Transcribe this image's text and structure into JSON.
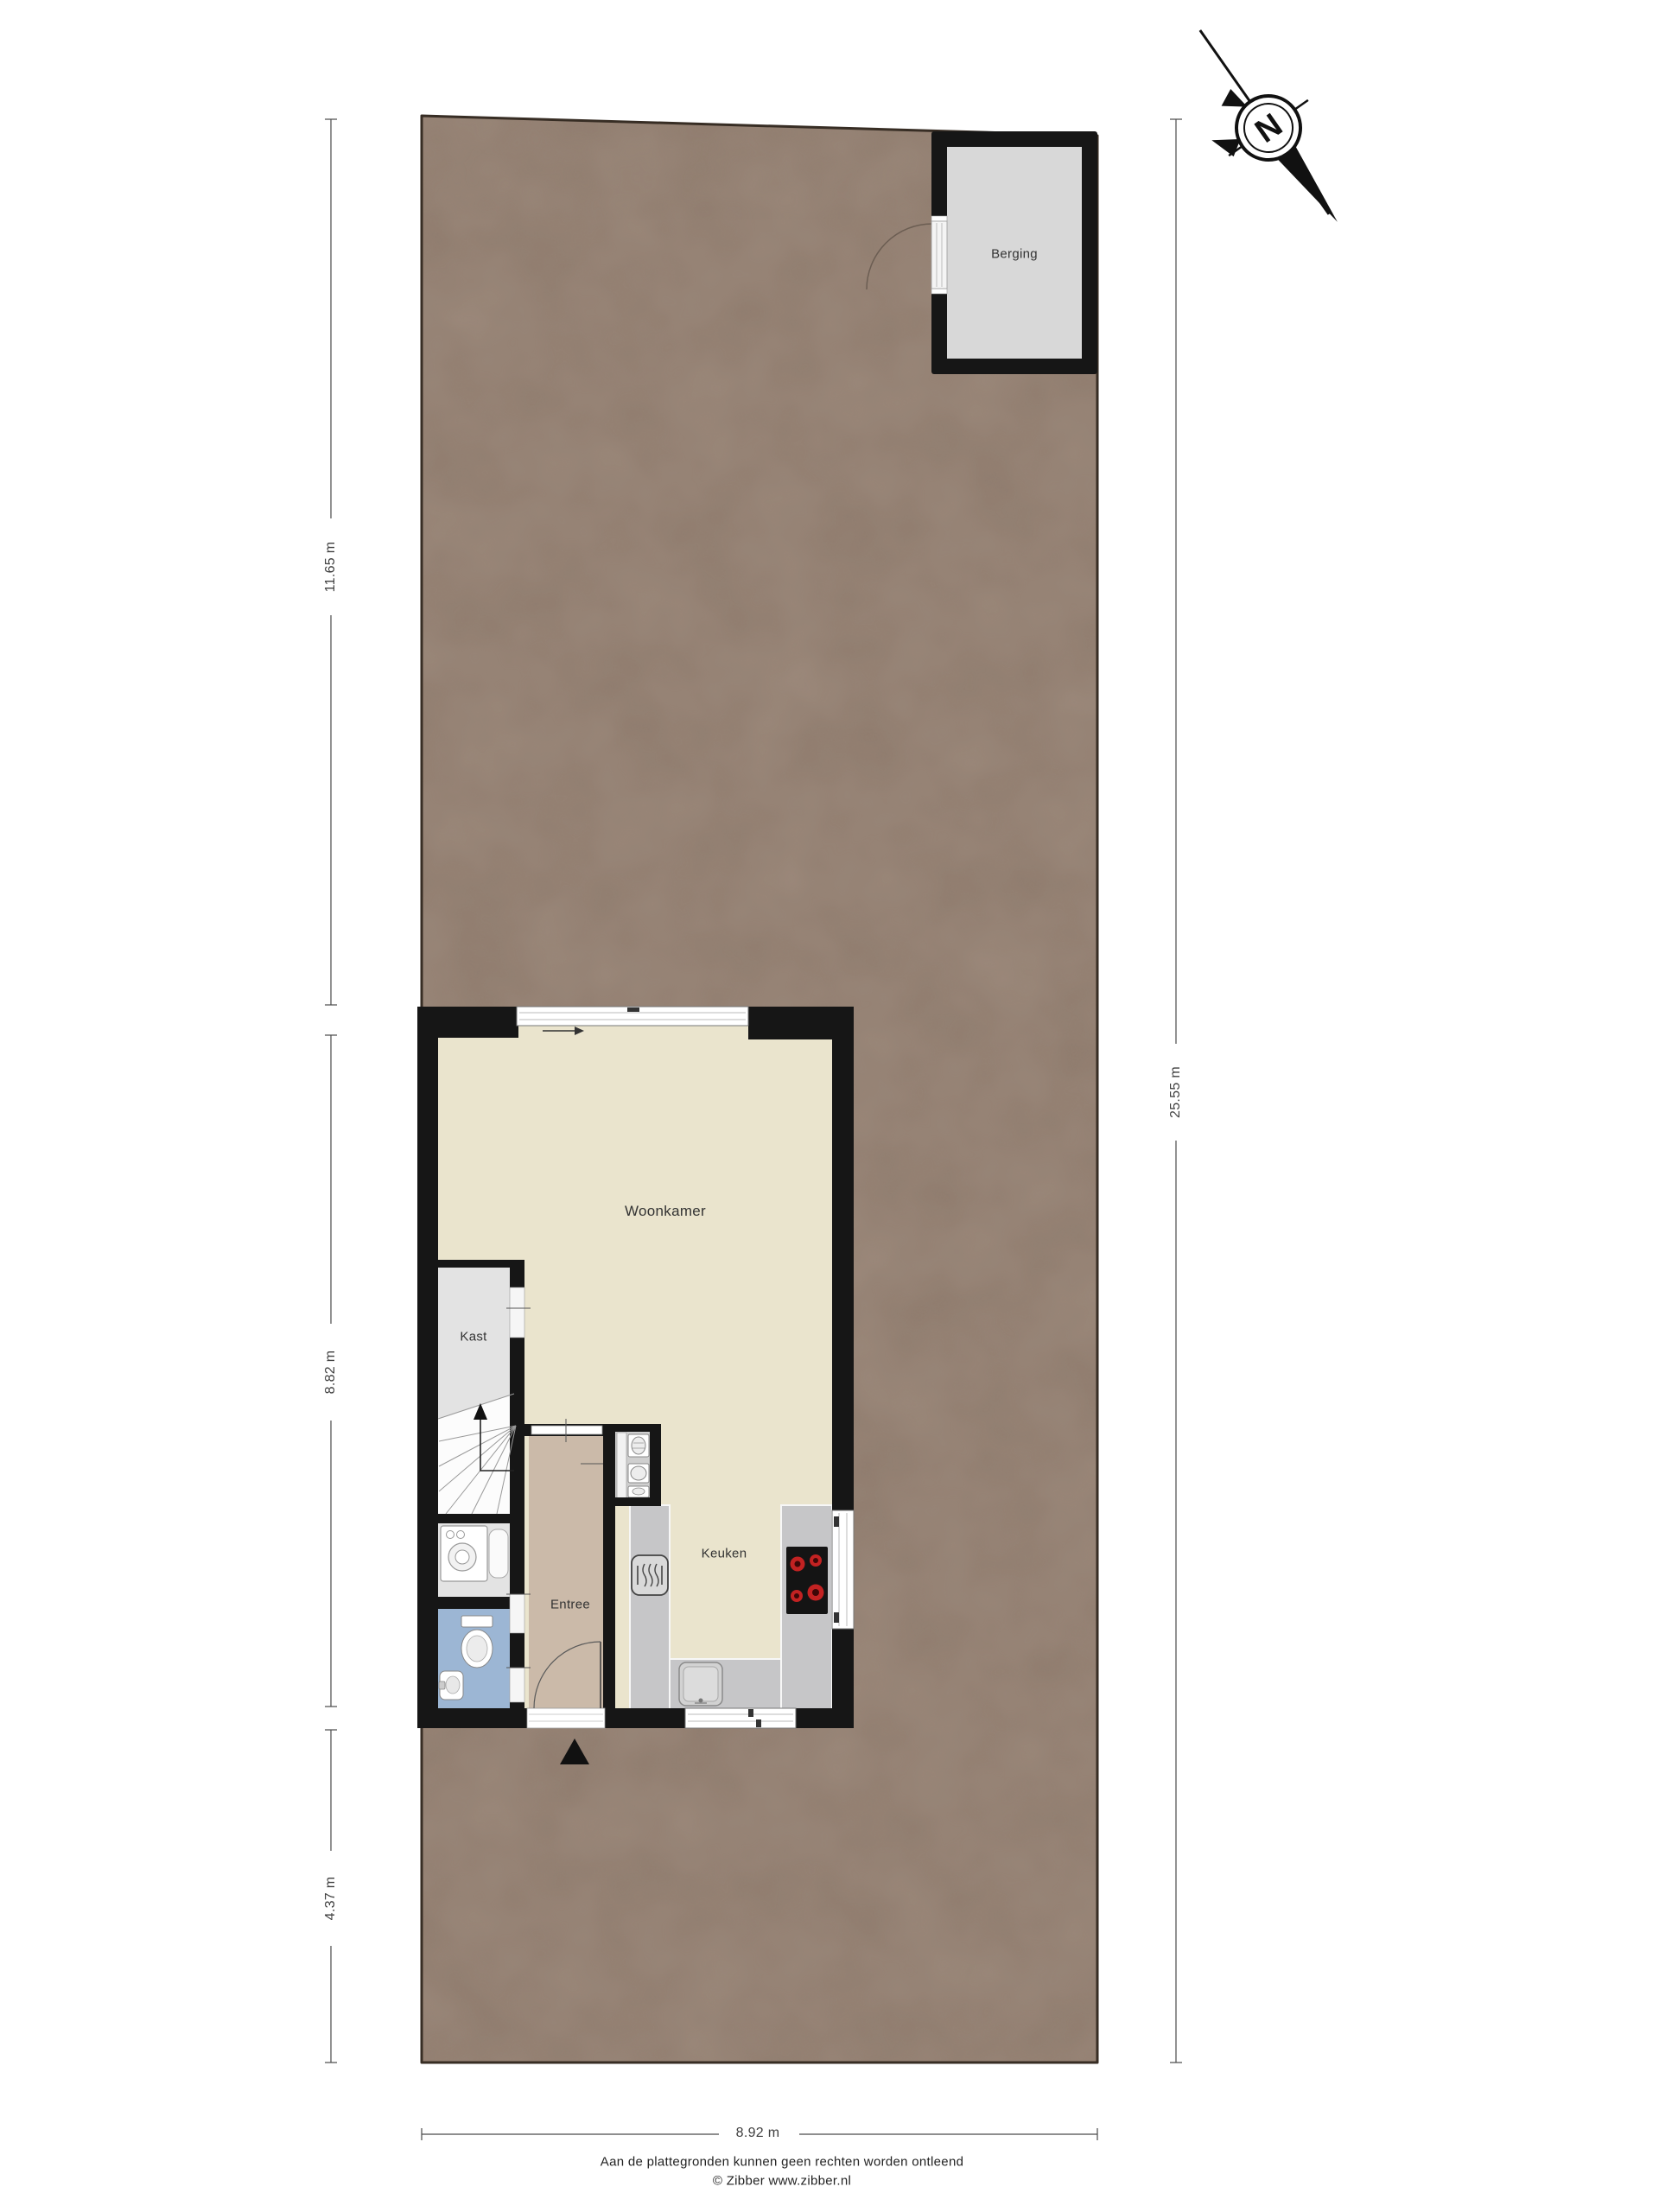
{
  "plan": {
    "title_rooms": {
      "berging": "Berging",
      "woonkamer": "Woonkamer",
      "kast": "Kast",
      "entree": "Entree",
      "keuken": "Keuken"
    },
    "dimensions": {
      "left_top": "11.65 m",
      "left_middle": "8.82 m",
      "left_bottom": "4.37 m",
      "right": "25.55 m",
      "bottom": "8.92 m"
    },
    "compass": {
      "north_label": "N"
    },
    "footer": {
      "line1": "Aan de plattegronden kunnen geen rechten worden ontleend",
      "line2": "© Zibber www.zibber.nl"
    },
    "colors": {
      "plot_ground": "#8e7a6c",
      "wall": "#161616",
      "woonkamer_floor": "#eae4cd",
      "entree_floor": "#cbbaa9",
      "toilet_floor": "#9cb6d4",
      "counter": "#c6c6c8",
      "kast_floor": "#e3e3e3",
      "berging_floor": "#d8d8d8",
      "burner_red": "#c22222"
    },
    "icons": {
      "compass": "north-arrow-icon",
      "stairs": "stairs-icon",
      "washing_machine": "washing-machine-icon",
      "toilet": "toilet-icon",
      "hand_basin": "hand-basin-icon",
      "heater": "heater-icon",
      "cooktop": "cooktop-icon",
      "kitchen_sink": "kitchen-sink-icon",
      "entrance_marker": "entrance-arrow-icon"
    }
  }
}
